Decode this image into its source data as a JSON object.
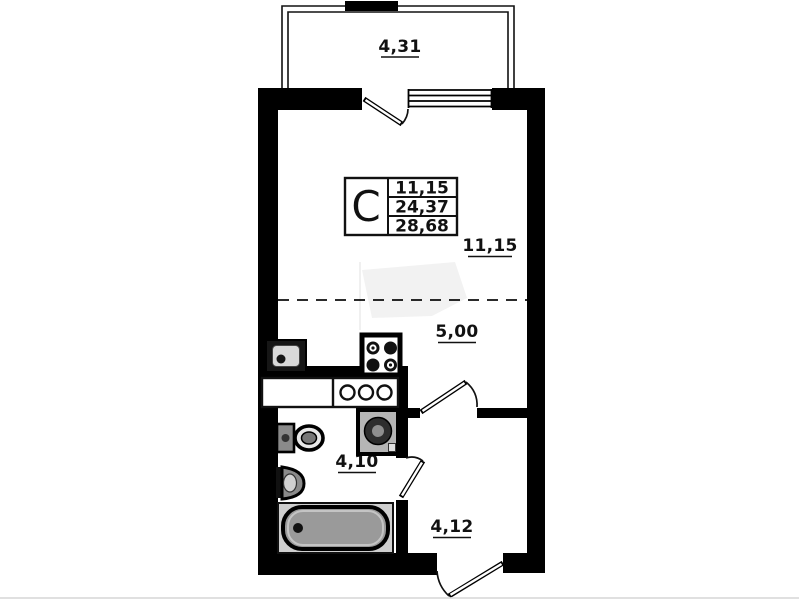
{
  "page": {
    "background": "#ffffff"
  },
  "colors": {
    "wall": "#000000",
    "line": "#111111",
    "text": "#111111",
    "fixture_gray": "#9a9a9a",
    "panel_gray": "#cfcfcf"
  },
  "unit_table": {
    "type_label": "С",
    "rows": [
      "11,15",
      "24,37",
      "28,68"
    ]
  },
  "labels": {
    "balcony_area": "4,31",
    "living_area": "11,15",
    "kitchen_area": "5,00",
    "bathroom_area": "4,10",
    "hallway_area": "4,12"
  }
}
